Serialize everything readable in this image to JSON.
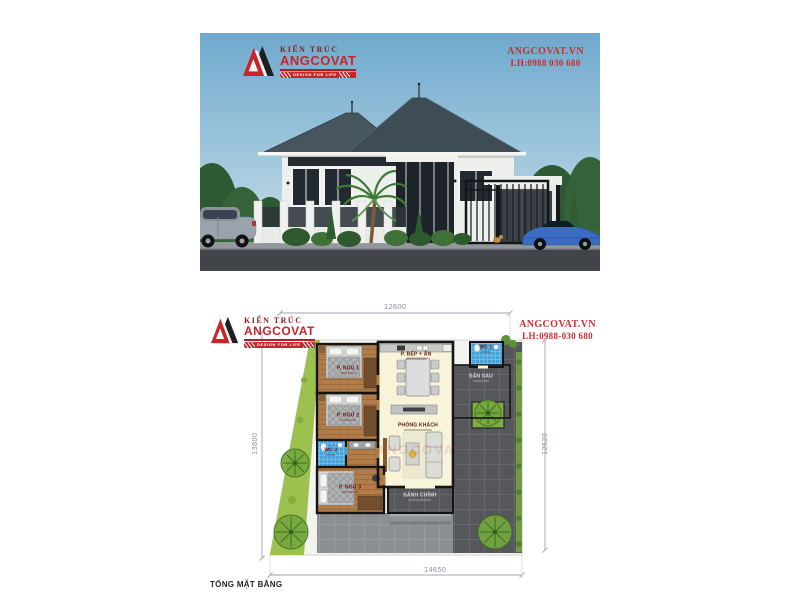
{
  "render_panel": {
    "logo": {
      "tagline_top": "KIẾN TRÚC",
      "brand": "ANGCOVAT",
      "banner": "DESIGN FOR LIFE"
    },
    "contact": {
      "website": "ANGCOVAT.VN",
      "phone": "LH:0988 030 680"
    }
  },
  "plan_panel": {
    "logo": {
      "tagline_top": "KIẾN TRÚC",
      "brand": "ANGCOVAT",
      "banner": "DESIGN FOR LIFE"
    },
    "contact": {
      "website": "ANGCOVAT.VN",
      "phone": "LH:0988-030 680"
    },
    "title": "TỔNG MẶT BẰNG",
    "watermark": "ANGCOVAT",
    "dimensions": {
      "top": "12600",
      "left": "13800",
      "right": "12620",
      "bottom": "14650"
    },
    "rooms": [
      {
        "name": "P. BẾP + ĂN"
      },
      {
        "name": "WC 1"
      },
      {
        "name": "SÂN SAU"
      },
      {
        "name": "P. NGỦ 1"
      },
      {
        "name": "P. NGỦ 2"
      },
      {
        "name": "WC 2"
      },
      {
        "name": "P. NGỦ 3"
      },
      {
        "name": "PHÒNG KHÁCH"
      },
      {
        "name": "SẢNH CHÍNH"
      }
    ]
  },
  "colors": {
    "brand_red": "#c4262c",
    "contact_red": "#cf2b30",
    "roof": "#45545d",
    "sky": "#6fa9cd",
    "wc_tile": "#45a3da",
    "wood_floor": "#b27d49",
    "lawn": "#9dc14e",
    "paving": "#56575b",
    "interior_cream": "#f7f4da"
  }
}
